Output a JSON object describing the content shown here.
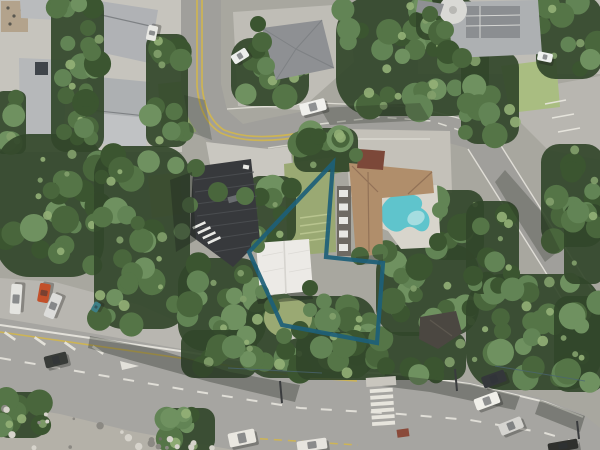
{
  "map": {
    "type": "aerial-photograph",
    "width": 600,
    "height": 450,
    "description": "satellite view of hillside suburb with property boundary overlay"
  },
  "boundary": {
    "points": "333,163 249,252 282,325 377,343 383,263 326,257",
    "color": "#1d5f78",
    "stroke_width": 4.2,
    "opacity": 0.92
  },
  "palette": {
    "ground_base": "#a8a79f",
    "pad_light": "#c6c4bd",
    "pad_mid": "#bfbdb6",
    "concrete": "#c9c7c0",
    "concrete2": "#c4c1b9",
    "road_upper": "#a09f9b",
    "road_lower": "#a6a5a1",
    "parking": "#b8b6b0",
    "bank_rock": "#b4b1a8",
    "lawn": "#a9bd81",
    "garden": "#9aa973",
    "garden_light": "#b8c48f",
    "dirt": "#b4a083",
    "green_bank": "#7f9463",
    "deck_tan": "#b3a38c",
    "roof_gray_1": "#b9bbbd",
    "roof_gray_2": "#b0b2b5",
    "roof_gray_3": "#b6b8ba",
    "roof_gray_4": "#adb0b2",
    "roof_gray_5": "#c0c2c4",
    "roof_dark": "#8e9093",
    "roof_dark_line": "#7e8184",
    "roof_black": "#37393c",
    "roof_black_rib": "#4d5053",
    "roof_white": "#eceae6",
    "roof_white_line": "#d6d4cf",
    "roof_brown": "#b08e6b",
    "roof_brown_line": "#927257",
    "garage_red": "#7c4839",
    "facade_dark": "#6e6a63",
    "window_white": "#e8e8e4",
    "patio": "#d8d5cc",
    "pool": "#5fc4cc",
    "pool_light": "#a5dde0",
    "shed_dark": "#4b4741",
    "shed_line": "#5d584f",
    "panel_dark": "#8b8e91",
    "tank_white": "#d9d9d5",
    "marking_white": "#eae8e0",
    "marking_yellow": "#d2b64c",
    "shadow": "rgba(38,44,34,0.34)",
    "shadow_deep": "rgba(32,38,30,0.42)",
    "wire": "#4a6573",
    "pole": "#3a3c3e",
    "skylight_dark": "#3f444a",
    "island_concrete": "#c9c6be",
    "red_patch": "#8a4a3a"
  },
  "trees": {
    "base": "#32462a",
    "canopy": [
      "#3b5530",
      "#49663c",
      "#557547",
      "#628455",
      "#6f9160"
    ],
    "highlight": [
      "#83a06b",
      "#93b077"
    ],
    "regions": [
      [
        55,
        0,
        45,
        148,
        16
      ],
      [
        150,
        38,
        34,
        105,
        10
      ],
      [
        235,
        42,
        70,
        60,
        11
      ],
      [
        340,
        0,
        145,
        112,
        26
      ],
      [
        420,
        0,
        34,
        36,
        5
      ],
      [
        540,
        0,
        58,
        75,
        8
      ],
      [
        545,
        148,
        55,
        95,
        10
      ],
      [
        465,
        55,
        50,
        85,
        9
      ],
      [
        0,
        95,
        22,
        55,
        5
      ],
      [
        0,
        138,
        100,
        135,
        24
      ],
      [
        98,
        150,
        88,
        175,
        26
      ],
      [
        182,
        262,
        80,
        85,
        15
      ],
      [
        250,
        300,
        122,
        74,
        20
      ],
      [
        300,
        336,
        162,
        40,
        12
      ],
      [
        380,
        248,
        95,
        84,
        18
      ],
      [
        470,
        278,
        128,
        108,
        22
      ],
      [
        165,
        412,
        46,
        36,
        8
      ],
      [
        0,
        396,
        42,
        38,
        7
      ],
      [
        250,
        180,
        42,
        60,
        8
      ],
      [
        298,
        132,
        56,
        36,
        7
      ],
      [
        432,
        194,
        48,
        62,
        9
      ],
      [
        558,
        300,
        42,
        88,
        8
      ],
      [
        470,
        205,
        45,
        85,
        10
      ],
      [
        568,
        208,
        32,
        72,
        6
      ],
      [
        185,
        334,
        68,
        40,
        9
      ]
    ],
    "overhang": [
      [
        448,
        52,
        12,
        0
      ],
      [
        462,
        58,
        10,
        1
      ],
      [
        445,
        30,
        9,
        2
      ],
      [
        430,
        14,
        8,
        1
      ],
      [
        262,
        42,
        10,
        1
      ],
      [
        266,
        66,
        9,
        3
      ],
      [
        258,
        24,
        8,
        0
      ],
      [
        92,
        52,
        9,
        2
      ],
      [
        88,
        28,
        8,
        1
      ],
      [
        86,
        98,
        9,
        0
      ],
      [
        84,
        128,
        10,
        3
      ],
      [
        64,
        132,
        8,
        1
      ],
      [
        196,
        168,
        9,
        1
      ],
      [
        190,
        205,
        8,
        2
      ],
      [
        258,
        246,
        7,
        2
      ],
      [
        310,
        288,
        8,
        0
      ],
      [
        262,
        292,
        7,
        3
      ],
      [
        360,
        256,
        9,
        1
      ],
      [
        380,
        252,
        8,
        2
      ],
      [
        438,
        242,
        9,
        0
      ],
      [
        440,
        210,
        8,
        3
      ],
      [
        356,
        155,
        7,
        2
      ],
      [
        272,
        306,
        8,
        1
      ],
      [
        300,
        330,
        9,
        0
      ],
      [
        284,
        336,
        8,
        2
      ],
      [
        310,
        310,
        7,
        3
      ],
      [
        218,
        192,
        10,
        1
      ],
      [
        245,
        196,
        9,
        2
      ]
    ]
  },
  "rocks": {
    "x": 2,
    "y": 406,
    "w": 230,
    "h": 42,
    "n": 26,
    "base_line": [
      404,
      0.2
    ],
    "colors": [
      "#6e6c65",
      "#d6d3cb",
      "#8b8983"
    ]
  },
  "crossing": {
    "x": 371,
    "y": 388.5,
    "count": 6,
    "stripe_w": 23,
    "stripe_h": 3.8,
    "gap": 2.8,
    "rot": -4,
    "cx": 382.5,
    "cy": 408
  },
  "cars": [
    [
      313,
      107,
      26,
      12,
      -15,
      "#f0f0ec"
    ],
    [
      240,
      56,
      17,
      10,
      -32,
      "#eceeec"
    ],
    [
      152,
      33,
      15,
      10,
      -78,
      "#e8e8e4"
    ],
    [
      16,
      299,
      30,
      11,
      -86,
      "#e4e4e0"
    ],
    [
      44,
      293,
      19,
      11,
      -80,
      "#c2502a"
    ],
    [
      53,
      306,
      25,
      11,
      -68,
      "#dcdcda"
    ],
    [
      96,
      307,
      10,
      7,
      -60,
      "#3d7f86"
    ],
    [
      56,
      360,
      23,
      12,
      -14,
      "#383b38"
    ],
    [
      242,
      438,
      27,
      14,
      -12,
      "#e9e7e0"
    ],
    [
      312,
      445,
      30,
      11,
      -8,
      "#e6e4de"
    ],
    [
      494,
      379,
      24,
      12,
      -20,
      "#34373a"
    ],
    [
      487,
      401,
      25,
      12,
      -20,
      "#f0efe9"
    ],
    [
      511,
      426,
      24,
      12,
      -22,
      "#d5d4d0"
    ],
    [
      563,
      446,
      30,
      10,
      -10,
      "#2f302d"
    ],
    [
      545,
      57,
      15,
      9,
      12,
      "#eef0ee"
    ]
  ],
  "wires": [
    [
      495,
      366,
      585,
      381
    ],
    [
      228,
      368,
      322,
      373
    ]
  ],
  "poles": [
    [
      280,
      381,
      282,
      403
    ],
    [
      455,
      369,
      457,
      391
    ],
    [
      577,
      421,
      579,
      439
    ]
  ]
}
